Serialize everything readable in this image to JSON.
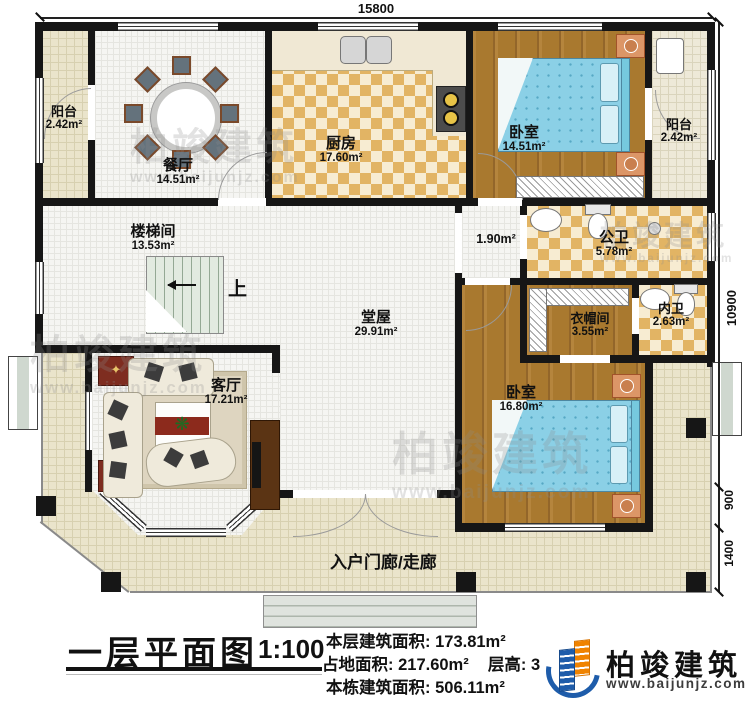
{
  "title_block": {
    "title": "一层平面图",
    "scale": "1:100",
    "floor_area_label": "本层建筑面积:",
    "floor_area_value": "173.81m²",
    "land_area_label": "占地面积:",
    "land_area_value": "217.60m²",
    "floor_height_label": "层高:",
    "floor_height_value": "3",
    "total_area_label": "本栋建筑面积:",
    "total_area_value": "506.11m²"
  },
  "brand": {
    "name": "柏竣建筑",
    "url": "www.baijunjz.com",
    "blue": "#1e5caa",
    "orange": "#f08300"
  },
  "watermark": {
    "name": "柏竣建筑",
    "url": "www.baijunjz.com"
  },
  "dimensions": {
    "top_width": "15800",
    "right_total": "10900",
    "right_porch": "900",
    "right_steps": "1400"
  },
  "rooms": {
    "balcony_left": {
      "name": "阳台",
      "area": "2.42m²"
    },
    "dining": {
      "name": "餐厅",
      "area": "14.51m²"
    },
    "kitchen": {
      "name": "厨房",
      "area": "17.60m²"
    },
    "bedroom_top": {
      "name": "卧室",
      "area": "14.51m²"
    },
    "balcony_right": {
      "name": "阳台",
      "area": "2.42m²"
    },
    "stairwell": {
      "name": "楼梯间",
      "area": "13.53m²"
    },
    "corridor": {
      "area": "1.90m²"
    },
    "public_bath": {
      "name": "公卫",
      "area": "5.78m²"
    },
    "hall": {
      "name": "堂屋",
      "area": "29.91m²"
    },
    "cloakroom": {
      "name": "衣帽间",
      "area": "3.55m²"
    },
    "private_bath": {
      "name": "内卫",
      "area": "2.63m²"
    },
    "living": {
      "name": "客厅",
      "area": "17.21m²"
    },
    "bedroom_bottom": {
      "name": "卧室",
      "area": "16.80m²"
    },
    "porch": {
      "name": "入户门廊/走廊"
    },
    "stairs_up": "上"
  }
}
